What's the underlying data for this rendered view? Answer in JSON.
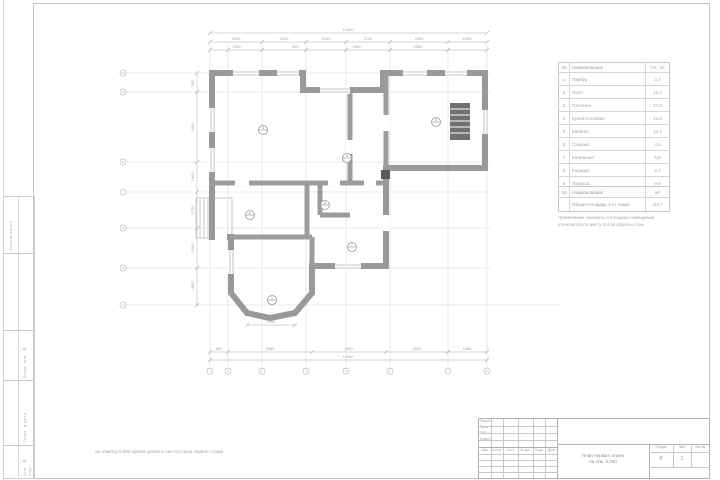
{
  "plan": {
    "caption": "За отметку 0,000 принят уровень чистого пола первого этажа",
    "tags": [
      "3",
      "4",
      "5",
      "2",
      "6",
      "7",
      "1"
    ],
    "dims": {
      "overall_top": "13460",
      "top": [
        "2530",
        "2140",
        "1940",
        "2140",
        "2820",
        "1890"
      ],
      "top2": [
        "1500",
        "900",
        "1060",
        "1350"
      ],
      "left": [
        "950",
        "3400",
        "1460",
        "1750",
        "1940",
        "1800"
      ],
      "bottom": [
        "880",
        "4080",
        "3620",
        "3000",
        "1880"
      ],
      "overall_bottom": "13460",
      "bay": "1500"
    },
    "axes": {
      "cols": [
        "1",
        "2",
        "3",
        "4",
        "5",
        "6",
        "7",
        "8"
      ],
      "rows": [
        "А",
        "Б",
        "В",
        "Г",
        "Д",
        "Е",
        "Ж"
      ]
    }
  },
  "explication": {
    "headers": {
      "num": "№",
      "name": "Наименование",
      "area": "Пл., м²"
    },
    "rows": [
      {
        "num": "1",
        "name": "Тамбур",
        "area": "3,4"
      },
      {
        "num": "2",
        "name": "Холл",
        "area": "15,2"
      },
      {
        "num": "3",
        "name": "Гостиная",
        "area": "27,8"
      },
      {
        "num": "4",
        "name": "Кухня-столовая",
        "area": "21,6"
      },
      {
        "num": "5",
        "name": "Кабинет",
        "area": "13,1"
      },
      {
        "num": "6",
        "name": "Санузел",
        "area": "4,6"
      },
      {
        "num": "7",
        "name": "Котельная",
        "area": "6,8"
      },
      {
        "num": "8",
        "name": "Коридор",
        "area": "8,4"
      },
      {
        "num": "9",
        "name": "Терраса",
        "area": "9,8"
      }
    ]
  },
  "summary": {
    "headers": {
      "num": "№",
      "name": "Наименование",
      "area": "м²"
    },
    "row": {
      "num": "",
      "name": "Общая площадь 1-го этажа",
      "area": "110,7"
    }
  },
  "note": {
    "line1": "Примечание: размеры и площади помещений",
    "line2": "уточняются по месту после отделки стен."
  },
  "titleblock": {
    "rev": {
      "izm": "Изм.",
      "kol": "Кол.уч",
      "list": "Лист",
      "doc": "№ док.",
      "podp": "Подп.",
      "data": "Дата"
    },
    "staff": [
      {
        "role": "Разраб."
      },
      {
        "role": "Пров."
      },
      {
        "role": "ГИП"
      },
      {
        "role": "Н.контр."
      }
    ],
    "stage_label": "Стадия",
    "sheet_label": "Лист",
    "sheets_label": "Листов",
    "stage": "Р",
    "sheet": "1",
    "title_line1": "План первого этажа",
    "title_line2": "на отм. 0,000"
  },
  "left_strip": {
    "cells": [
      "Согласовано",
      "Взам. инв. №",
      "Подп. и дата",
      "Инв. № подл."
    ]
  }
}
